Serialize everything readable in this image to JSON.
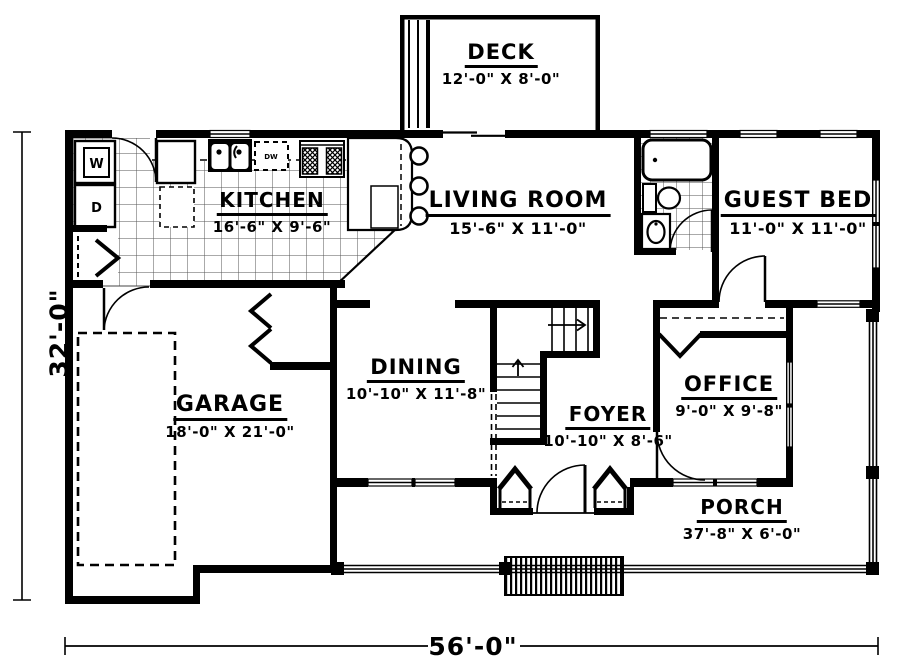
{
  "title": "First floor house plan",
  "rooms": {
    "deck": {
      "name": "DECK",
      "dims": "12'-0\" X 8'-0\""
    },
    "kitchen": {
      "name": "KITCHEN",
      "dims": "16'-6\" X 9'-6\""
    },
    "living": {
      "name": "LIVING ROOM",
      "dims": "15'-6\" X 11'-0\""
    },
    "guest": {
      "name": "GUEST BED",
      "dims": "11'-0\" X 11'-0\""
    },
    "garage": {
      "name": "GARAGE",
      "dims": "18'-0\" X 21'-0\""
    },
    "dining": {
      "name": "DINING",
      "dims": "10'-10\" X 11'-8\""
    },
    "foyer": {
      "name": "FOYER",
      "dims": "10'-10\" X 8'-6\""
    },
    "office": {
      "name": "OFFICE",
      "dims": "9'-0\" X 9'-8\""
    },
    "porch": {
      "name": "PORCH",
      "dims": "37'-8\" X 6'-0\""
    }
  },
  "dimensions": {
    "overall_width": "56'-0\"",
    "overall_height": "32'-0\""
  },
  "appliances": {
    "washer": "W",
    "dryer": "D",
    "dishwasher": "DW"
  },
  "colors": {
    "ink": "#000000",
    "paper": "#ffffff"
  }
}
